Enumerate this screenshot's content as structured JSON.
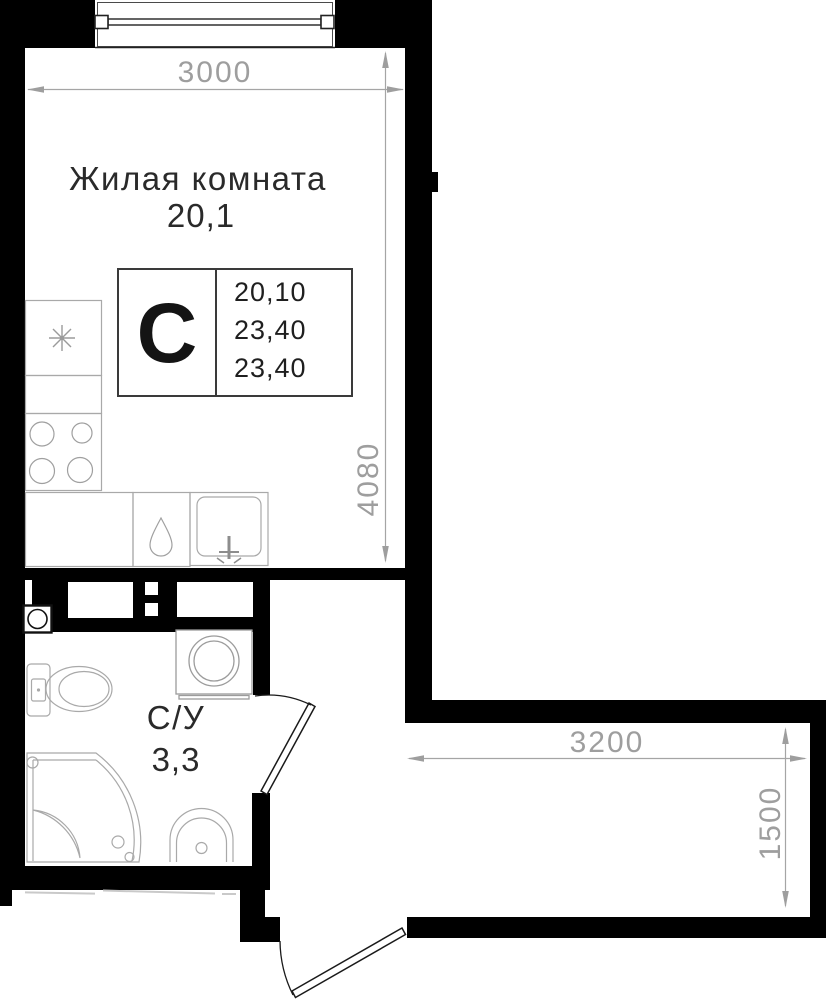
{
  "rooms": {
    "living": {
      "name": "Жилая комната",
      "area": "20,1"
    },
    "bathroom": {
      "name": "С/У",
      "area": "3,3"
    }
  },
  "stamp": {
    "letter": "С",
    "values": [
      "20,10",
      "23,40",
      "23,40"
    ]
  },
  "dimensions": {
    "width_top": "3000",
    "height_left": "4080",
    "hall_width": "3200",
    "hall_depth": "1500"
  },
  "colors": {
    "wall_black": "#000000",
    "dimension_gray": "#9e9e9e",
    "label_dark": "#262626",
    "fixture_gray": "#a9a9a9"
  }
}
